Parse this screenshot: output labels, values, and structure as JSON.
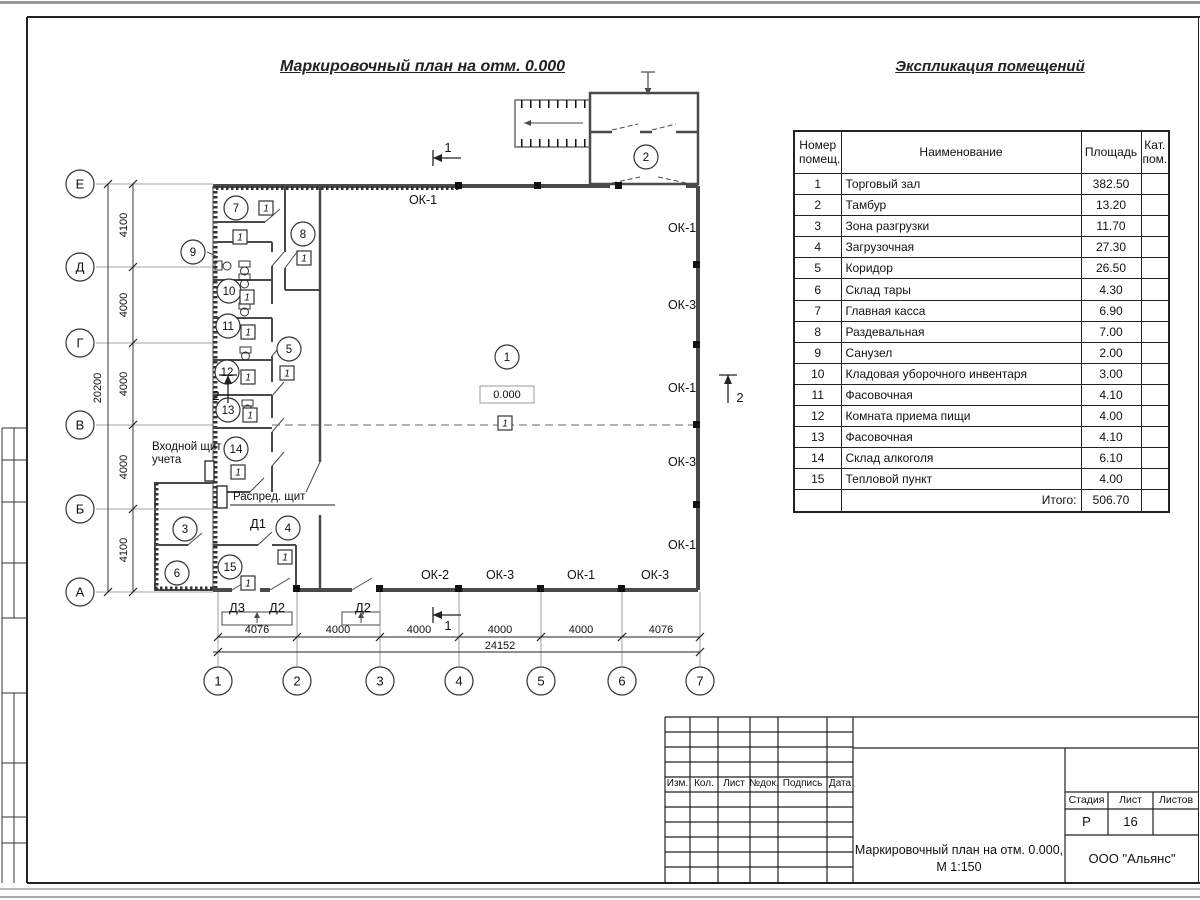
{
  "sheet": {
    "plan_title": "Маркировочный план на отм. 0.000",
    "schedule_title": "Экспликация помещений"
  },
  "schedule": {
    "headers": {
      "number": "Номер помещ.",
      "name": "Наименование",
      "area": "Площадь",
      "category": "Кат. пом."
    },
    "rows": [
      {
        "number": "1",
        "name": "Торговый зал",
        "area": "382.50",
        "category": ""
      },
      {
        "number": "2",
        "name": "Тамбур",
        "area": "13.20",
        "category": ""
      },
      {
        "number": "3",
        "name": "Зона разгрузки",
        "area": "11.70",
        "category": ""
      },
      {
        "number": "4",
        "name": "Загрузочная",
        "area": "27.30",
        "category": ""
      },
      {
        "number": "5",
        "name": "Коридор",
        "area": "26.50",
        "category": ""
      },
      {
        "number": "6",
        "name": "Склад тары",
        "area": "4.30",
        "category": ""
      },
      {
        "number": "7",
        "name": "Главная касса",
        "area": "6.90",
        "category": ""
      },
      {
        "number": "8",
        "name": "Раздевальная",
        "area": "7.00",
        "category": ""
      },
      {
        "number": "9",
        "name": "Санузел",
        "area": "2.00",
        "category": ""
      },
      {
        "number": "10",
        "name": "Кладовая уборочного инвентаря",
        "area": "3.00",
        "category": ""
      },
      {
        "number": "11",
        "name": "Фасовочная",
        "area": "4.10",
        "category": ""
      },
      {
        "number": "12",
        "name": "Комната приема пищи",
        "area": "4.00",
        "category": ""
      },
      {
        "number": "13",
        "name": "Фасовочная",
        "area": "4.10",
        "category": ""
      },
      {
        "number": "14",
        "name": "Склад алкоголя",
        "area": "6.10",
        "category": ""
      },
      {
        "number": "15",
        "name": "Тепловой пункт",
        "area": "4.00",
        "category": ""
      }
    ],
    "total_label": "Итого:",
    "total_area": "506.70"
  },
  "plan": {
    "elevation_mark": "0.000",
    "grid": {
      "columns": [
        {
          "label": "1",
          "x": 218
        },
        {
          "label": "2",
          "x": 297
        },
        {
          "label": "3",
          "x": 380
        },
        {
          "label": "4",
          "x": 459
        },
        {
          "label": "5",
          "x": 541
        },
        {
          "label": "6",
          "x": 622
        },
        {
          "label": "7",
          "x": 700
        }
      ],
      "rows": [
        {
          "label": "Е",
          "y": 184
        },
        {
          "label": "Д",
          "y": 267
        },
        {
          "label": "Г",
          "y": 343
        },
        {
          "label": "В",
          "y": 425
        },
        {
          "label": "Б",
          "y": 509
        },
        {
          "label": "А",
          "y": 592
        }
      ]
    },
    "dims": {
      "bottom_segments": [
        {
          "text": "4076",
          "x": 257
        },
        {
          "text": "4000",
          "x": 338
        },
        {
          "text": "4000",
          "x": 419
        },
        {
          "text": "4000",
          "x": 500
        },
        {
          "text": "4000",
          "x": 581
        },
        {
          "text": "4076",
          "x": 661
        }
      ],
      "bottom_total": {
        "text": "24152",
        "x": 500
      },
      "left_segments": [
        {
          "text": "4100",
          "y": 225
        },
        {
          "text": "4000",
          "y": 305
        },
        {
          "text": "4000",
          "y": 384
        },
        {
          "text": "4000",
          "y": 467
        },
        {
          "text": "4100",
          "y": 550
        }
      ],
      "left_total": {
        "text": "20200",
        "y": 388
      }
    },
    "rooms": [
      {
        "num": "1",
        "x": 507,
        "y": 357
      },
      {
        "num": "2",
        "x": 646,
        "y": 157
      },
      {
        "num": "3",
        "x": 185,
        "y": 529
      },
      {
        "num": "4",
        "x": 288,
        "y": 528
      },
      {
        "num": "5",
        "x": 289,
        "y": 349
      },
      {
        "num": "6",
        "x": 177,
        "y": 573
      },
      {
        "num": "7",
        "x": 236,
        "y": 208
      },
      {
        "num": "8",
        "x": 303,
        "y": 234
      },
      {
        "num": "9",
        "x": 193,
        "y": 252
      },
      {
        "num": "10",
        "x": 229,
        "y": 291
      },
      {
        "num": "11",
        "x": 228,
        "y": 326
      },
      {
        "num": "12",
        "x": 227,
        "y": 372
      },
      {
        "num": "13",
        "x": 228,
        "y": 410
      },
      {
        "num": "14",
        "x": 236,
        "y": 449
      },
      {
        "num": "15",
        "x": 230,
        "y": 567
      }
    ],
    "floor_marks": [
      {
        "label": "1",
        "x": 266,
        "y": 208
      },
      {
        "label": "1",
        "x": 240,
        "y": 237
      },
      {
        "label": "1",
        "x": 304,
        "y": 258
      },
      {
        "label": "1",
        "x": 247,
        "y": 297
      },
      {
        "label": "1",
        "x": 248,
        "y": 332
      },
      {
        "label": "1",
        "x": 248,
        "y": 377
      },
      {
        "label": "1",
        "x": 250,
        "y": 415
      },
      {
        "label": "1",
        "x": 238,
        "y": 472
      },
      {
        "label": "1",
        "x": 287,
        "y": 373
      },
      {
        "label": "1",
        "x": 505,
        "y": 423
      },
      {
        "label": "1",
        "x": 285,
        "y": 557
      },
      {
        "label": "1",
        "x": 248,
        "y": 583
      }
    ],
    "windows": [
      {
        "label": "ОК-1",
        "x": 423,
        "y": 200
      },
      {
        "label": "ОК-1",
        "x": 682,
        "y": 228
      },
      {
        "label": "ОК-3",
        "x": 682,
        "y": 305
      },
      {
        "label": "ОК-1",
        "x": 682,
        "y": 388
      },
      {
        "label": "ОК-3",
        "x": 682,
        "y": 462
      },
      {
        "label": "ОК-1",
        "x": 682,
        "y": 545
      },
      {
        "label": "ОК-2",
        "x": 435,
        "y": 575
      },
      {
        "label": "ОК-3",
        "x": 500,
        "y": 575
      },
      {
        "label": "ОК-1",
        "x": 581,
        "y": 575
      },
      {
        "label": "ОК-3",
        "x": 655,
        "y": 575
      }
    ],
    "doors": [
      {
        "label": "Д1",
        "x": 258,
        "y": 524
      },
      {
        "label": "Д3",
        "x": 237,
        "y": 608
      },
      {
        "label": "Д2",
        "x": 277,
        "y": 608
      },
      {
        "label": "Д2",
        "x": 363,
        "y": 608
      }
    ],
    "sections": [
      {
        "label": "1",
        "type": "h",
        "x": 433,
        "y": 158,
        "lx": 448,
        "ly": 152
      },
      {
        "label": "1",
        "type": "h",
        "x": 433,
        "y": 615,
        "lx": 448,
        "ly": 630
      },
      {
        "label": "2",
        "type": "v",
        "x": 228,
        "y": 403,
        "lx": 216,
        "ly": 400
      },
      {
        "label": "2",
        "type": "v",
        "x": 728,
        "y": 403,
        "lx": 740,
        "ly": 402
      }
    ],
    "annotations": {
      "entry_panel_line1": "Входной щит",
      "entry_panel_line2": "учета",
      "dist_panel": "Распред. щит"
    }
  },
  "title_block": {
    "revision_headers": [
      "Изм.",
      "Кол.",
      "Лист",
      "№док.",
      "Подпись",
      "Дата"
    ],
    "stage_label": "Стадия",
    "sheet_label": "Лист",
    "sheets_label": "Листов",
    "stage_value": "Р",
    "sheet_value": "16",
    "sheets_value": "",
    "drawing_title_line1": "Маркировочный план на отм. 0.000,",
    "drawing_title_line2": "М 1:150",
    "company": "ООО \"Альянс\""
  }
}
